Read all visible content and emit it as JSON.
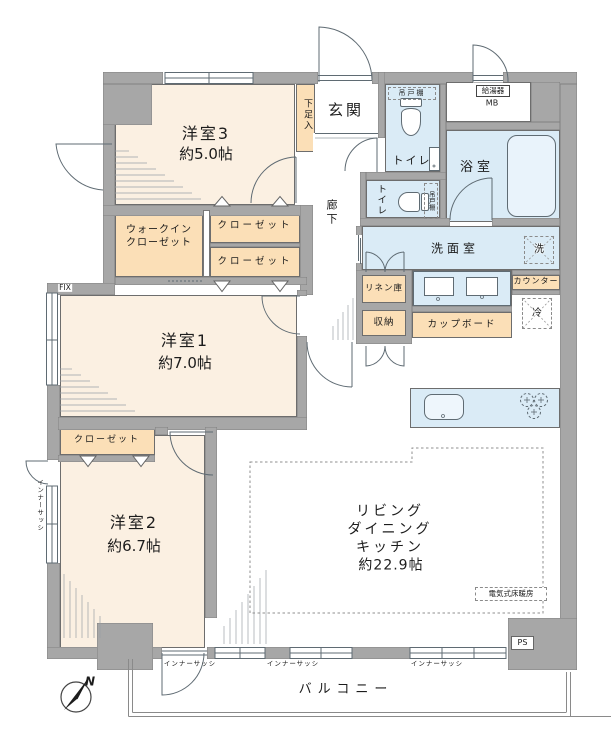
{
  "palette": {
    "wall": "#a7a7a7",
    "room_cream": "#fbf0e2",
    "closet_orange": "#fbdfb7",
    "wet_area_blue": "#daebf6",
    "line": "#5f6b73",
    "background": "#ffffff"
  },
  "rooms": {
    "bedroom3": {
      "name": "洋室3",
      "area": "約5.0帖"
    },
    "bedroom1": {
      "name": "洋室1",
      "area": "約7.0帖"
    },
    "bedroom2": {
      "name": "洋室2",
      "area": "約6.7帖"
    },
    "ldk": {
      "line1": "リビング",
      "line2": "ダイニング",
      "line3": "キッチン",
      "area": "約22.9帖",
      "floor_heating_note": "電気式床暖房"
    },
    "entrance": {
      "name": "玄関"
    },
    "hallway": {
      "name": "廊下"
    },
    "toilet_upper": {
      "name": "トイレ"
    },
    "toilet_lower": {
      "name": "トイレ"
    },
    "bathroom": {
      "name": "浴室"
    },
    "washroom": {
      "name": "洗面室"
    },
    "balcony": {
      "name": "バルコニー"
    }
  },
  "storage": {
    "walk_in_closet_line1": "ウォークイン",
    "walk_in_closet_line2": "クローゼット",
    "closet_bedroom3": "クローゼット",
    "closet_bedroom1": "クローゼット",
    "closet_bedroom2": "クローゼット",
    "shoe_cabinet": "下足入",
    "linen_cabinet": "リネン庫",
    "storage_cabinet": "収納",
    "cupboard": "カップボード",
    "kitchen_counter": "カウンター"
  },
  "equipment": {
    "hanging_cupboard_upper": "吊戸棚",
    "hanging_cupboard_lower": "吊戸棚",
    "water_heater": "給湯器",
    "meter_box": "MB",
    "washer_space": "洗",
    "refrigerator_space": "冷",
    "pipe_space": "PS",
    "fixed_window": "FIX",
    "inner_sash": "インナーサッシ",
    "compass_north": "N"
  }
}
